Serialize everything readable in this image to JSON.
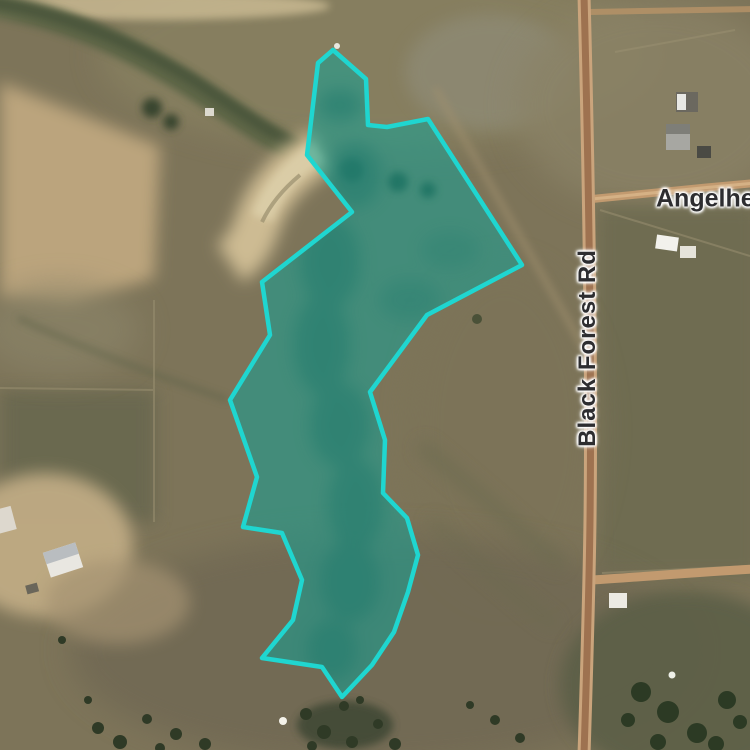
{
  "map": {
    "view_type": "satellite",
    "labels": {
      "black_forest_rd": {
        "text": "Black Forest Rd",
        "orientation": "vertical"
      },
      "angelhea": {
        "text": "Angelhea"
      }
    },
    "parcel": {
      "stroke_color": "#1fd6d0",
      "fill_color": "rgba(16,162,151,0.53)",
      "points": [
        [
          333,
          50
        ],
        [
          366,
          79
        ],
        [
          368,
          125
        ],
        [
          387,
          127
        ],
        [
          428,
          119
        ],
        [
          522,
          265
        ],
        [
          427,
          315
        ],
        [
          370,
          392
        ],
        [
          385,
          440
        ],
        [
          383,
          493
        ],
        [
          407,
          518
        ],
        [
          418,
          555
        ],
        [
          408,
          592
        ],
        [
          394,
          632
        ],
        [
          372,
          665
        ],
        [
          342,
          697
        ],
        [
          322,
          667
        ],
        [
          262,
          658
        ],
        [
          293,
          620
        ],
        [
          302,
          580
        ],
        [
          282,
          533
        ],
        [
          243,
          527
        ],
        [
          257,
          477
        ],
        [
          230,
          400
        ],
        [
          270,
          335
        ],
        [
          262,
          282
        ],
        [
          352,
          212
        ],
        [
          307,
          155
        ],
        [
          318,
          63
        ]
      ]
    }
  }
}
